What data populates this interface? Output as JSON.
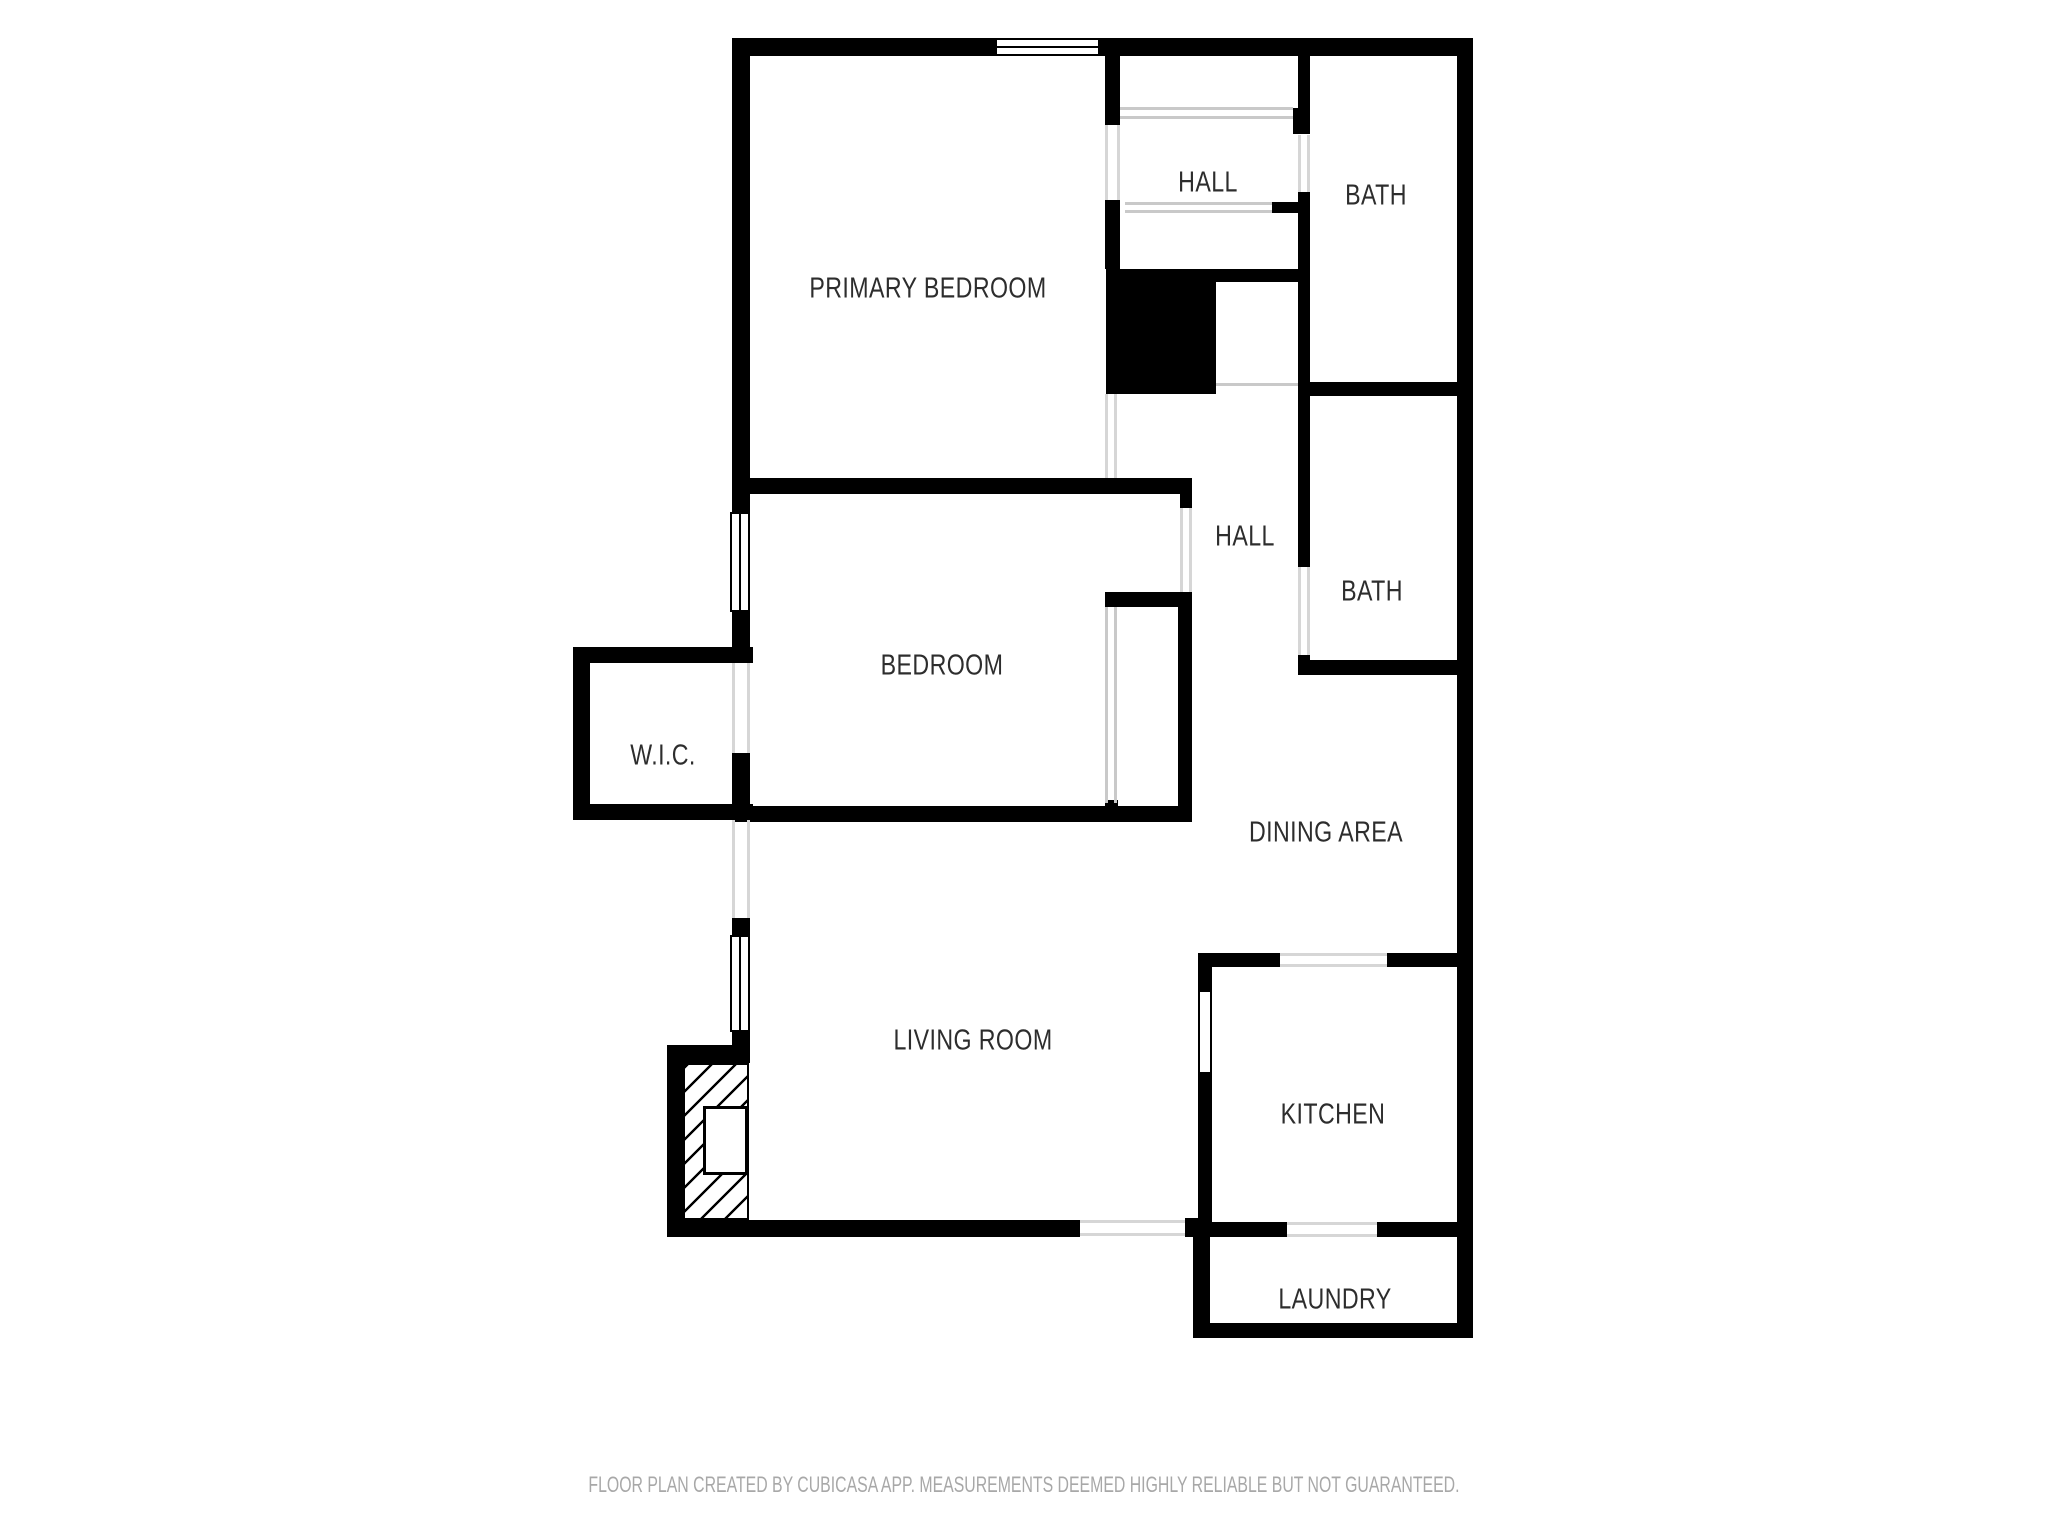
{
  "rooms": {
    "primary_bedroom": {
      "label": "PRIMARY BEDROOM"
    },
    "hall_upper": {
      "label": "HALL"
    },
    "bath_upper": {
      "label": "BATH"
    },
    "hall_lower": {
      "label": "HALL"
    },
    "bath_lower": {
      "label": "BATH"
    },
    "bedroom": {
      "label": "BEDROOM"
    },
    "wic": {
      "label": "W.I.C."
    },
    "dining_area": {
      "label": "DINING AREA"
    },
    "living_room": {
      "label": "LIVING ROOM"
    },
    "kitchen": {
      "label": "KITCHEN"
    },
    "laundry": {
      "label": "LAUNDRY"
    }
  },
  "footer": {
    "disclaimer": "FLOOR PLAN CREATED BY CUBICASA APP. MEASUREMENTS DEEMED HIGHLY RELIABLE BUT NOT GUARANTEED."
  },
  "colors": {
    "wall": "#000000",
    "background": "#ffffff",
    "room_label": "#2d2d2d",
    "footer_text": "#a8a8a8",
    "opening_line": "#d6d6d6",
    "closet_line": "#c9c9c9"
  }
}
